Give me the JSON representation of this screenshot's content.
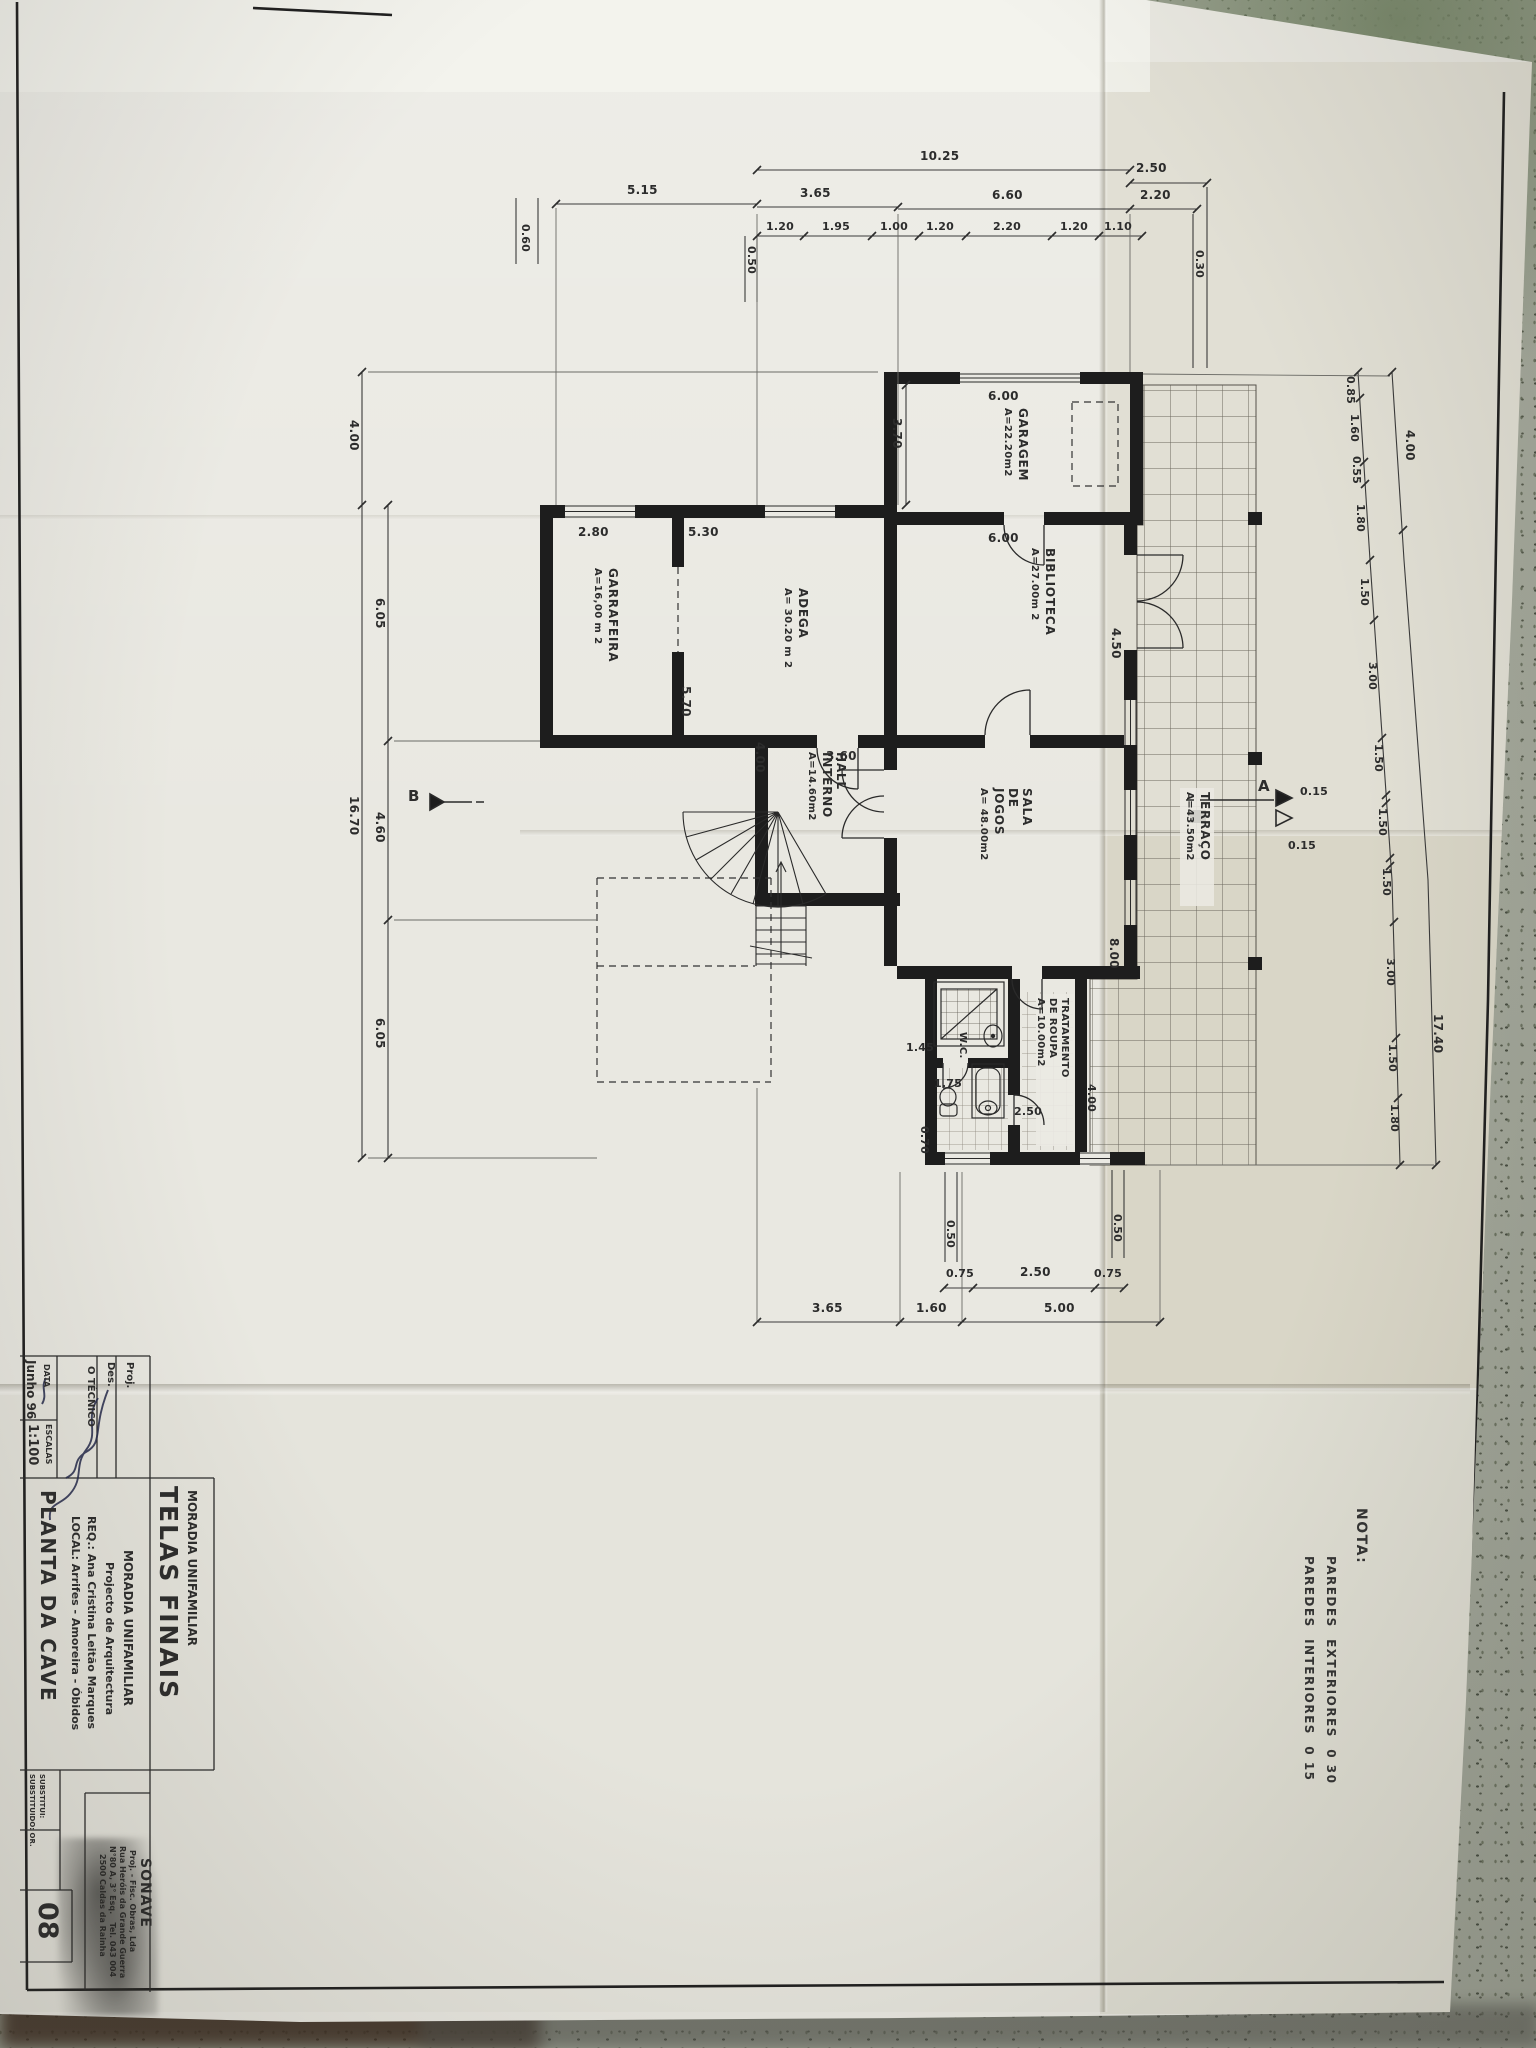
{
  "note": {
    "title": "NOTA:",
    "line1": "PAREDES  EXTERIORES  0 30",
    "line2": "PAREDES  INTERIORES  0 15"
  },
  "rooms": [
    {
      "label": "GARAGEM",
      "area": "A=22.20m2"
    },
    {
      "label": "BIBLIOTECA",
      "area": "A=27.00m 2"
    },
    {
      "label": "ADEGA",
      "area": "A= 30.20 m 2"
    },
    {
      "label": "GARRAFEIRA",
      "area": "A=16,00 m 2"
    },
    {
      "label": "HALL\nINTERNO",
      "area": "A=14.60m2"
    },
    {
      "label": "SALA\nDE\nJOGOS",
      "area": "A= 48.00m2"
    },
    {
      "label": "TERRAÇO",
      "area": "A=43.50m2"
    },
    {
      "label": "TRATAMENTO\nDE ROUPA",
      "area": "A=10.00m2"
    },
    {
      "label": "W.C."
    }
  ],
  "dims": {
    "top1": [
      "10.25",
      "2.50"
    ],
    "top2": [
      "5.15",
      "3.65",
      "6.60",
      "2.20"
    ],
    "top3": [
      "1.20",
      "1.95",
      "1.00",
      "1.20",
      "2.20",
      "1.20",
      "1.10"
    ],
    "top_small": [
      "0.60",
      "0.50",
      "0.30"
    ],
    "left_outer": [
      "4.00",
      "16.70"
    ],
    "left_inner": [
      "6.05",
      "4.60",
      "6.05"
    ],
    "right_inner": [
      "0.85",
      "1.60",
      "0.55",
      "1.80",
      "1.50",
      "3.00",
      "1.50",
      "1.50",
      "1.50",
      "3.00",
      "1.50",
      "1.80"
    ],
    "right_outer": [
      "4.00",
      "17.40"
    ],
    "bottom1": [
      "0.50",
      "0.50"
    ],
    "bottom2": [
      "0.75",
      "2.50",
      "0.75"
    ],
    "bottom3": [
      "3.65",
      "1.60",
      "5.00"
    ],
    "plan": [
      "6.00",
      "6.00",
      "3.70",
      "2.80",
      "5.30",
      "5.70",
      "4.00",
      "3.60",
      "4.50",
      "8.00",
      "1.45",
      "1.75",
      "2.50",
      "0.70",
      "4.00"
    ]
  },
  "markers": {
    "section_a": "A",
    "section_b": "B",
    "a_dim1": "0.15",
    "a_dim2": "0.15"
  },
  "titleblock": {
    "proj_label": "Proj.",
    "des_label": "Des.",
    "tecnico_label": "O TÉCNICO",
    "data_label": "DATA",
    "data_value": "Junho 96",
    "escalas_label": "ESCALAS",
    "escalas_value": "1:100",
    "header_title": "TELAS FINAIS",
    "header_subtitle": "MORADIA UNIFAMILIAR",
    "project_name": "MORADIA UNIFAMILIAR",
    "project_type": "Projecto de Arquitectura",
    "req": "REQ.: Ana Cristina Leitão Marques",
    "local": "LOCAL: Arrifes - Amoreira - Óbidos",
    "sheet_title": "PLANTA DA CAVE",
    "company_name": "SONAVE",
    "company_line1": "Proj. - Fisc. Obras, Lda",
    "company_line2": "Rua Heróis da Grande Guerra",
    "company_line3": "N°80 A, 3° Esq.   Tel. 043 004",
    "company_line4": "2500 Caldas da Rainha",
    "substitui_label": "SUBSTITUI:",
    "substituido_label": "SUBSTITUIDO: OR.",
    "sheet_number": "08"
  }
}
